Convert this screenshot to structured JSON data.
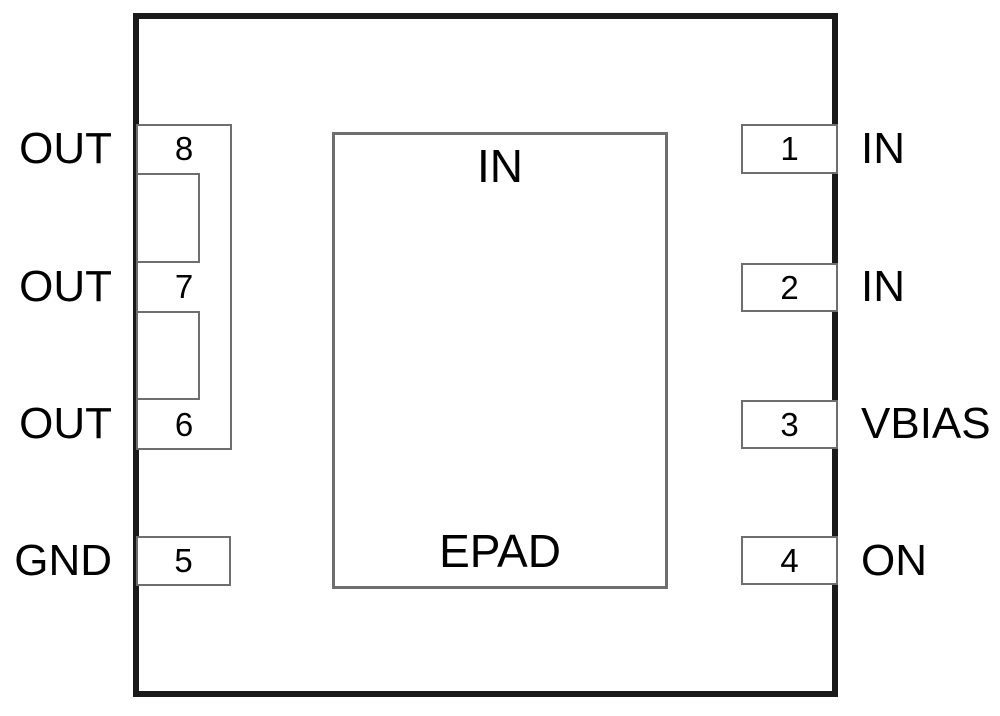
{
  "diagram": {
    "type": "ic-package-pinout",
    "epad": {
      "top_label": "IN",
      "bottom_label": "EPAD"
    },
    "pins": {
      "left": [
        {
          "number": "8",
          "label": "OUT"
        },
        {
          "number": "7",
          "label": "OUT"
        },
        {
          "number": "6",
          "label": "OUT"
        },
        {
          "number": "5",
          "label": "GND"
        }
      ],
      "right": [
        {
          "number": "1",
          "label": "IN"
        },
        {
          "number": "2",
          "label": "IN"
        },
        {
          "number": "3",
          "label": "VBIAS"
        },
        {
          "number": "4",
          "label": "ON"
        }
      ]
    },
    "colors": {
      "outline": "#1a1a1a",
      "pin_border": "#6e6e6e",
      "background": "#ffffff",
      "text": "#000000"
    }
  }
}
